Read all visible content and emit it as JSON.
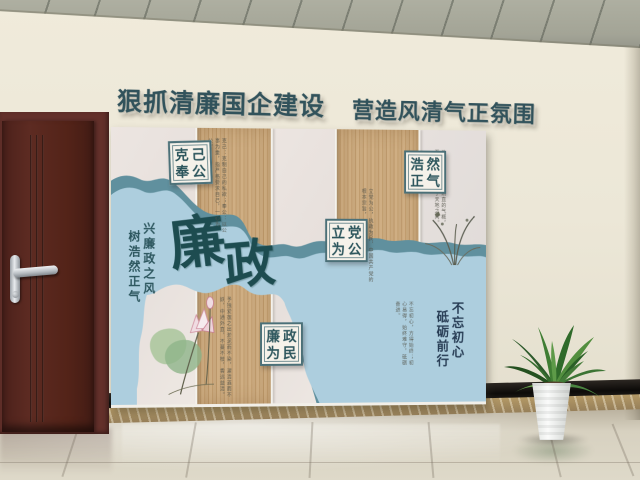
{
  "title": {
    "left": "狠抓清廉国企建设",
    "right": "营造风清气正氛围"
  },
  "board": {
    "calligraphy": {
      "char1": "廉",
      "char2": "政"
    },
    "slogan_left": {
      "col1": "兴廉政之风",
      "col2": "树浩然正气"
    },
    "slogan_right": {
      "col1": "不忘初心",
      "col2": "砥砺前行"
    },
    "badges": [
      {
        "id": "keji-fenggong",
        "chars": [
          "克",
          "己",
          "奉",
          "公"
        ]
      },
      {
        "id": "haoran-zhengqi",
        "chars": [
          "浩",
          "然",
          "正",
          "气"
        ]
      },
      {
        "id": "lidang-weigong",
        "chars": [
          "立",
          "党",
          "为",
          "公"
        ]
      },
      {
        "id": "lianzheng-weimin",
        "chars": [
          "廉",
          "政",
          "为",
          "民"
        ]
      }
    ],
    "notes": {
      "keji": "克己：克制自己的私欲；奉公：以公事为重，指严格要求自己，一心为公。",
      "haoran": "浩然正气：正大刚直的气概，至大至刚，充塞于天地之间。",
      "lidang": "立党为公，执政为民，中国共产党的根本宗旨，一切为了人民。",
      "lotus_panel": "予独爱莲之出淤泥而不染，濯清涟而不妖，中通外直，不蔓不枝，香远益清。",
      "chuxin": "不忘初心，方得始终；初心易得，始终难守，砥砺奋进。"
    }
  },
  "colors": {
    "title_text": "#31525b",
    "river_blue": "#adcede",
    "river_rim": "#60909e",
    "calligraphy": "#1d4c50",
    "badge_border": "#4b7078",
    "wood_panel": "#c5a377",
    "paper_panel": "#e9e2de",
    "wall": "#ece7d7",
    "ceiling": "#a3a496",
    "door": "#53251e",
    "baseboard": "#0d0b09",
    "floor_tile": "#d7d1c0",
    "plant_green": "#2f6a2a"
  }
}
